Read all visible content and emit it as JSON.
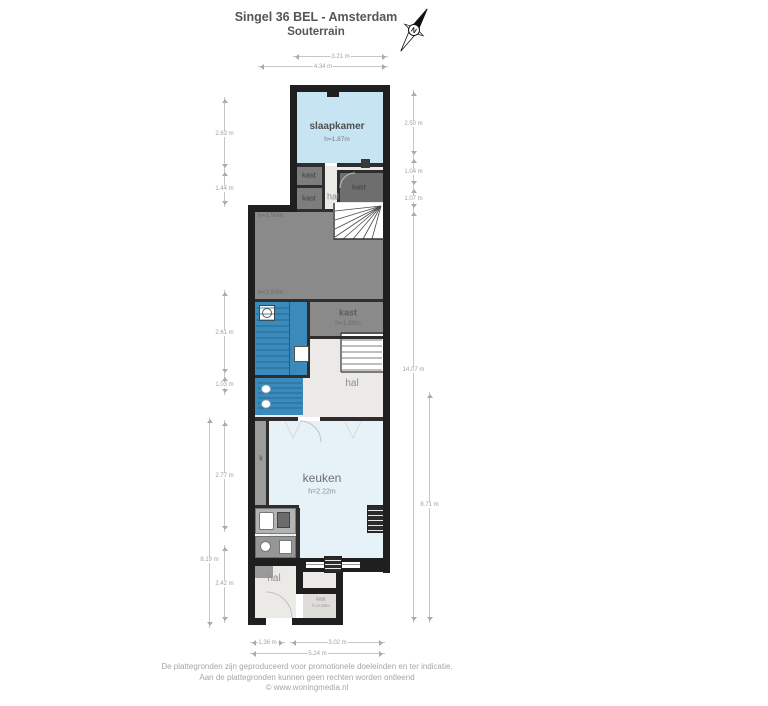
{
  "title": {
    "line1": "Singel 36 BEL - Amsterdam",
    "line2": "Souterrain"
  },
  "compass": {
    "n": "N"
  },
  "rooms": {
    "slaapkamer": {
      "name": "slaapkamer",
      "height": "h=1.87m"
    },
    "kast_a": {
      "name": "kast"
    },
    "kast_b": {
      "name": "kast"
    },
    "kast_c": {
      "name": "kast"
    },
    "hal_top": {
      "name": "hal"
    },
    "storage": {
      "height_top": "h=1.50m",
      "height_bottom": "h=1.50m"
    },
    "kast_mid": {
      "name": "kast",
      "height": "h=1.80m"
    },
    "hal_mid": {
      "name": "hal"
    },
    "k_strip": {
      "name": "k"
    },
    "keuken": {
      "name": "keuken",
      "height": "h=2.22m"
    },
    "hal_bottom": {
      "name": "hal"
    },
    "closet": {
      "name": "kast",
      "height": "h=0.60m"
    }
  },
  "dims": {
    "top": [
      {
        "label": "3.21 m"
      },
      {
        "label": "4.34 m"
      }
    ],
    "left": [
      {
        "label": "2.63 m"
      },
      {
        "label": "1.44 m"
      },
      {
        "label": "2.61 m"
      },
      {
        "label": "1.03 m"
      },
      {
        "label": "2.77 m"
      },
      {
        "label": "2.42 m"
      }
    ],
    "left_far": {
      "label": "8.19 m"
    },
    "right": [
      {
        "label": "2.50 m"
      },
      {
        "label": "1.04 m"
      },
      {
        "label": "1.07 m"
      },
      {
        "label": "14.07 m"
      }
    ],
    "right_far": {
      "label": "8.71 m"
    },
    "bottom": [
      {
        "label": "1.36 m"
      },
      {
        "label": "3.02 m"
      },
      {
        "label": "5.24 m"
      }
    ]
  },
  "footer": {
    "line1": "De plattegronden zijn geproduceerd voor promotionele doeleinden en ter indicatie.",
    "line2": "Aan de plattegronden kunnen geen rechten worden ontleend",
    "line3": "© www.woningmedia.nl"
  },
  "colors": {
    "wall": "#1f1f1f",
    "room_blue": "#c7e4f2",
    "room_blue_light": "#e7f2f8",
    "stairs_blue": "#3a8abb",
    "closet_gray": "#7d7d7d",
    "storage_gray": "#8a8a8a",
    "hall_gray": "#eceae6"
  }
}
